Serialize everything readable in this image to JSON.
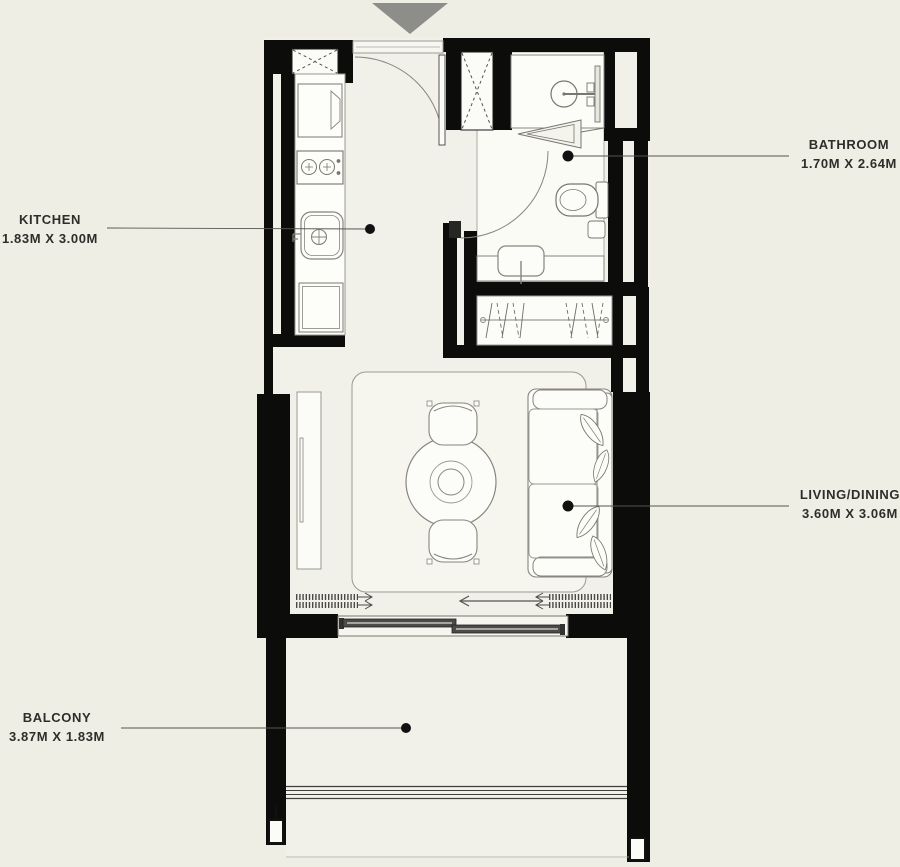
{
  "title": "Studio apartment floor plan",
  "colors": {
    "background": "#efeee5",
    "floor": "#f2f1e9",
    "wall": "#0c0c0b",
    "fixture": "#fcfcf8",
    "line": "#86857f",
    "entrance_arrow": "#8d8d8a",
    "label_text": "#2e2d29"
  },
  "entrance": {
    "icon": "down-triangle-icon"
  },
  "rooms": [
    {
      "id": "kitchen",
      "label": "KITCHEN",
      "dimensions": "1.83M X 3.00M",
      "label_side": "left"
    },
    {
      "id": "bathroom",
      "label": "BATHROOM",
      "dimensions": "1.70M X 2.64M",
      "label_side": "right"
    },
    {
      "id": "living_dining",
      "label": "LIVING/DINING",
      "dimensions": "3.60M X 3.06M",
      "label_side": "right"
    },
    {
      "id": "balcony",
      "label": "BALCONY",
      "dimensions": "3.87M X 1.83M",
      "label_side": "left"
    }
  ],
  "fixtures": [
    "entrance-arrow",
    "entry-door",
    "utility-shaft",
    "fridge",
    "stove",
    "kitchen-sink",
    "base-cabinet",
    "shower",
    "shower-door",
    "bathroom-door",
    "toilet",
    "vanity-basin",
    "wardrobe",
    "tv-console",
    "rug",
    "dining-table",
    "dining-chair",
    "sofa",
    "plant-leaves",
    "curtains",
    "sliding-door",
    "balcony-railing"
  ]
}
